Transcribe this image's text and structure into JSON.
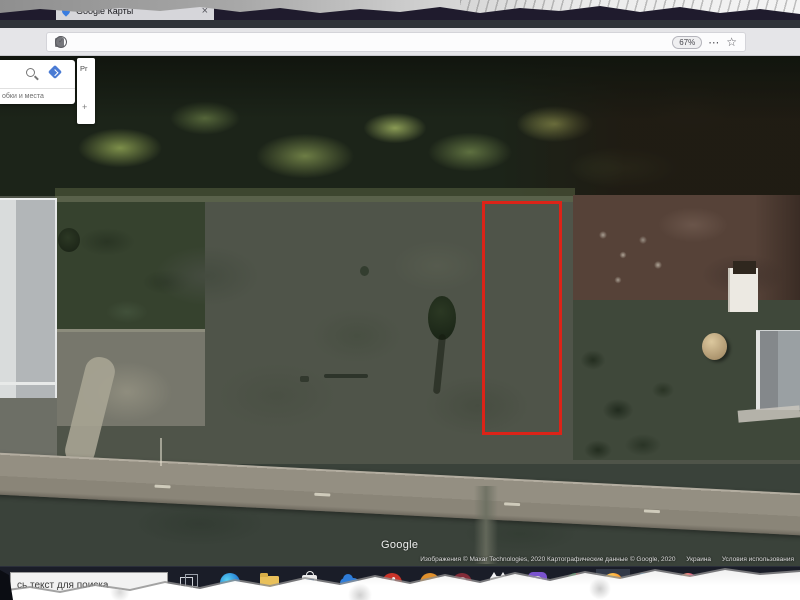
{
  "icons": {
    "close": "×",
    "dots": "⋯",
    "star": "☆",
    "check": "✓",
    "plus": "+",
    "chevron": "^"
  },
  "browser": {
    "tab_title": "Google Карты",
    "urlbar": {
      "prefix": "https://www.",
      "domain": "google.com.ua",
      "path": "/maps/@49.9362079,36.1058709,112m/data=!3m1!1e3?hl=ru",
      "zoom_badge": "67%"
    }
  },
  "map": {
    "panel": {
      "hint": "обки и места",
      "handle_text": "Pr"
    },
    "watermark": "Google",
    "attribution": {
      "imagery": "Изображения © Maxar Technologies, 2020  Картографические данные © Google, 2020",
      "region": "Украина",
      "terms": "Условия использования"
    }
  },
  "taskbar": {
    "search_text": "сь текст для поиска",
    "photoshop_label": "Ps"
  },
  "colors": {
    "plot_outline": "#dc2318",
    "titlebar": "#1f1b2d",
    "taskbar": "#1a1d28",
    "field_green": "#4f5449"
  }
}
